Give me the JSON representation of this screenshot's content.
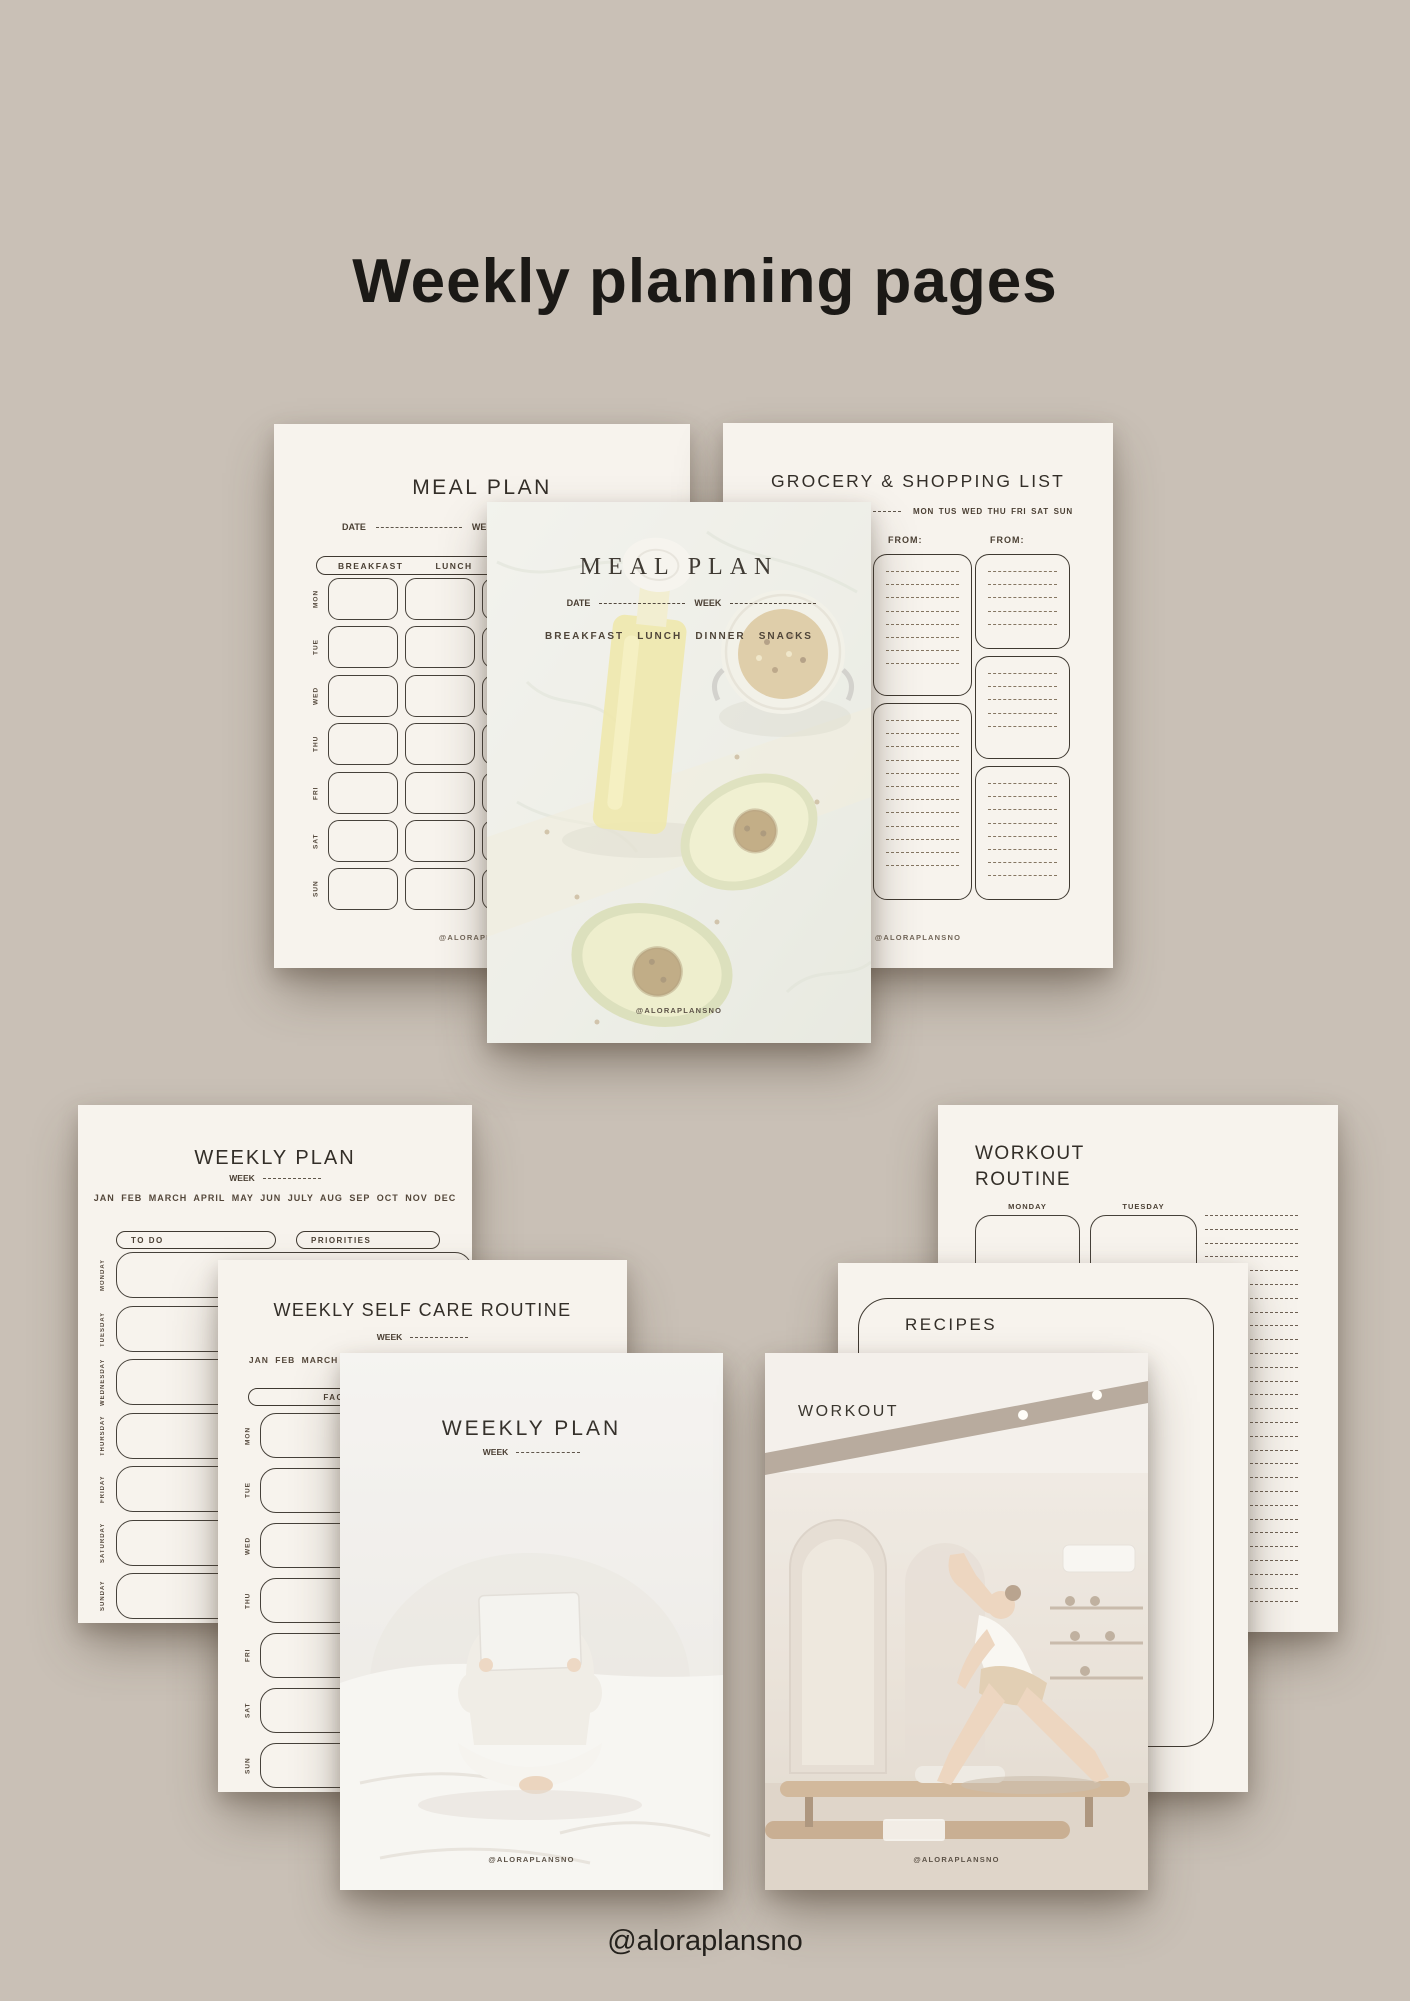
{
  "header": {
    "title": "Weekly planning pages"
  },
  "footer": {
    "handle": "@aloraplansno"
  },
  "watermark": "@ALORAPLANSNO",
  "colors": {
    "background": "#c9c0b6",
    "page": "#f7f3ed",
    "ink": "#3f3931",
    "dash": "#857662"
  },
  "meal_form": {
    "title": "MEAL PLAN",
    "date_label": "DATE",
    "week_label": "WEEK",
    "columns": [
      "BREAKFAST",
      "LUNCH"
    ],
    "days": [
      "MON",
      "TUE",
      "WED",
      "THU",
      "FRI",
      "SAT",
      "SUN"
    ]
  },
  "grocery": {
    "title": "GROCERY & SHOPPING LIST",
    "days": [
      "MON",
      "TUS",
      "WED",
      "THU",
      "FRI",
      "SAT",
      "SUN"
    ],
    "from_label": "FROM:"
  },
  "meal_cover": {
    "title": "MEAL PLAN",
    "date_label": "DATE",
    "week_label": "WEEK",
    "meals": [
      "BREAKFAST",
      "LUNCH",
      "DINNER",
      "SNACKS"
    ]
  },
  "weekly_form": {
    "title": "WEEKLY PLAN",
    "week_label": "WEEK",
    "months": "JAN FEB MARCH APRIL MAY JUN JULY AUG SEP OCT NOV DEC",
    "todo_label": "TO DO",
    "priorities_label": "PRIORITIES",
    "days": [
      "MONDAY",
      "TUESDAY",
      "WEDNESDAY",
      "THURSDAY",
      "FRIDAY",
      "SATURDAY",
      "SUNDAY"
    ]
  },
  "self_care": {
    "title": "WEEKLY SELF CARE ROUTINE",
    "week_label": "WEEK",
    "months": "JAN FEB MARCH APRIL MAY JUN JULY AUG SEP OCT NOV DEC",
    "face_label": "FACE",
    "days": [
      "MON",
      "TUE",
      "WED",
      "THU",
      "FRI",
      "SAT",
      "SUN"
    ]
  },
  "weekly_cover": {
    "title": "WEEKLY PLAN",
    "week_label": "WEEK"
  },
  "workout_routine": {
    "title_line1": "WORKOUT",
    "title_line2": "ROUTINE",
    "days": [
      "MONDAY",
      "TUESDAY"
    ]
  },
  "recipes": {
    "title": "RECIPES"
  },
  "workout_cover": {
    "title": "WORKOUT"
  }
}
